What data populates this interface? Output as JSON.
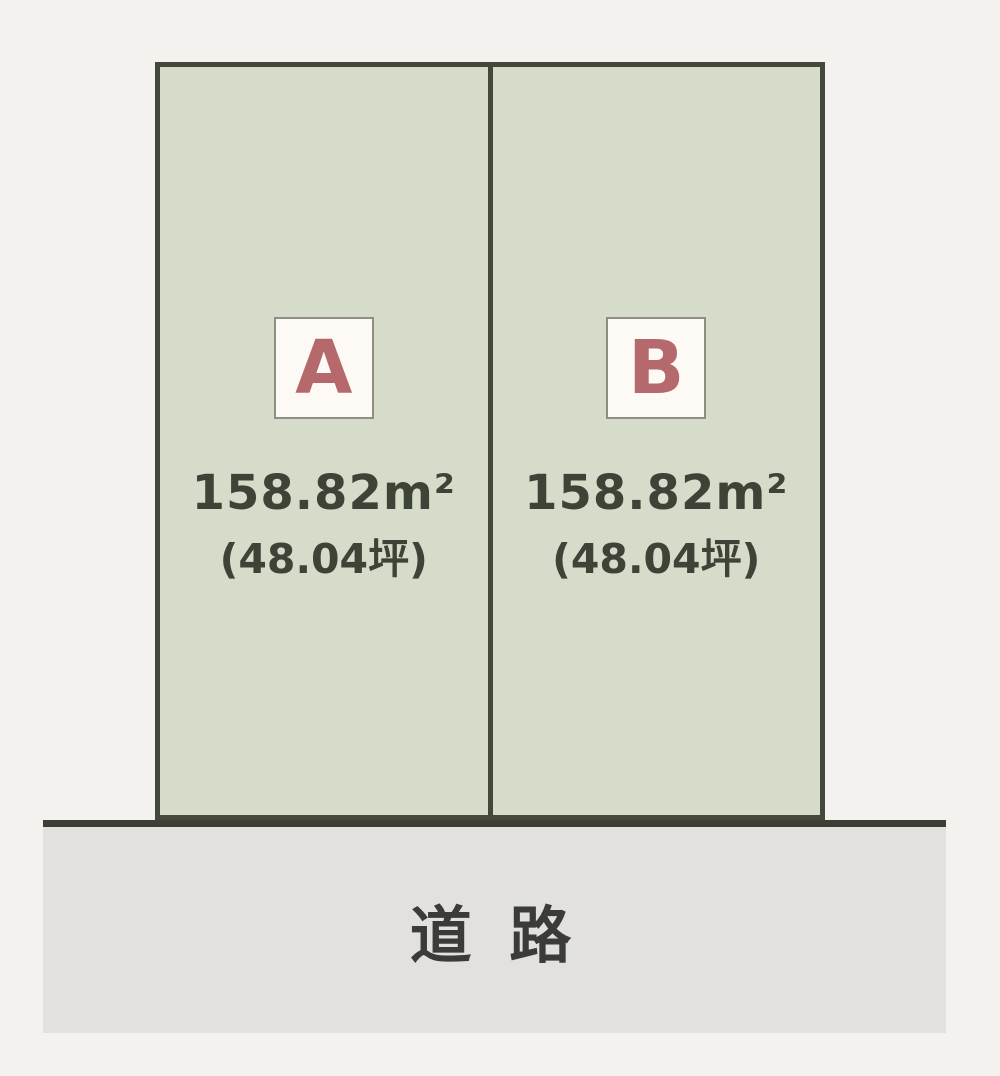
{
  "parcels": [
    {
      "id": "A",
      "area_m2": "158.82m²",
      "area_tsubo": "(48.04坪)"
    },
    {
      "id": "B",
      "area_m2": "158.82m²",
      "area_tsubo": "(48.04坪)"
    }
  ],
  "road": {
    "label": "道 路"
  },
  "colors": {
    "background": "#f4f2ee",
    "lot_fill": "#d5dcc9",
    "lot_border": "#44483a",
    "label_box_fill": "#fdfaf5",
    "label_box_border": "#8d8d83",
    "letter_accent": "#b5696d",
    "area_text": "#3e4337",
    "road_fill": "#e2e1dd",
    "road_border": "#3c3f35",
    "road_text": "#3b3b38"
  }
}
